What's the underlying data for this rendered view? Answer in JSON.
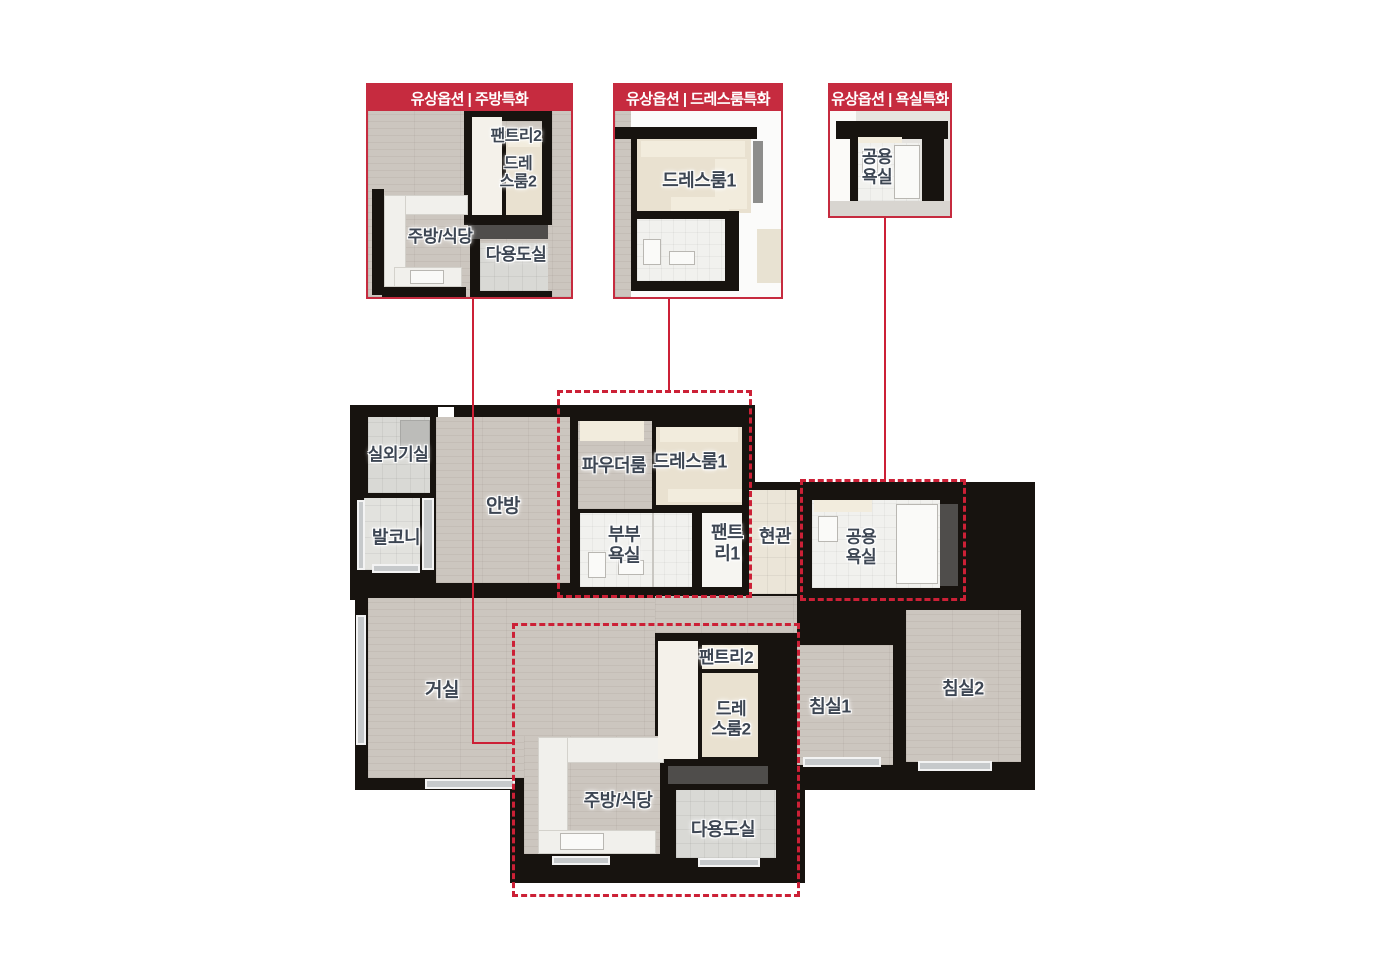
{
  "callouts": {
    "kitchen": {
      "title": "유상옵션 | 주방특화",
      "labels": {
        "pantry2": "팬트리2",
        "dressroom2": "드레\n스룸2",
        "kitchen_dining": "주방/식당",
        "utility": "다용도실"
      }
    },
    "dressroom": {
      "title": "유상옵션 | 드레스룸특화",
      "labels": {
        "dressroom1": "드레스룸1"
      }
    },
    "bathroom": {
      "title": "유상옵션 | 욕실특화",
      "labels": {
        "common_bath": "공용\n욕실"
      }
    }
  },
  "plan": {
    "rooms": {
      "outdoor_unit": "실외기실",
      "balcony": "발코니",
      "master_bedroom": "안방",
      "powder_room": "파우더룸",
      "dressroom1": "드레스룸1",
      "master_bath": "부부\n욕실",
      "pantry1": "팬트\n리1",
      "entrance": "현관",
      "common_bath": "공용\n욕실",
      "living_room": "거실",
      "bedroom1": "침실1",
      "bedroom2": "침실2",
      "pantry2": "팬트리2",
      "dressroom2": "드레\n스룸2",
      "kitchen_dining": "주방/식당",
      "utility": "다용도실"
    }
  },
  "colors": {
    "option_header_red": "#c62b3f",
    "highlight_line_red": "#cc2036",
    "wall_black": "#17130f",
    "wood_floor": "#ccc6bf",
    "label_text": "#3d4653"
  }
}
